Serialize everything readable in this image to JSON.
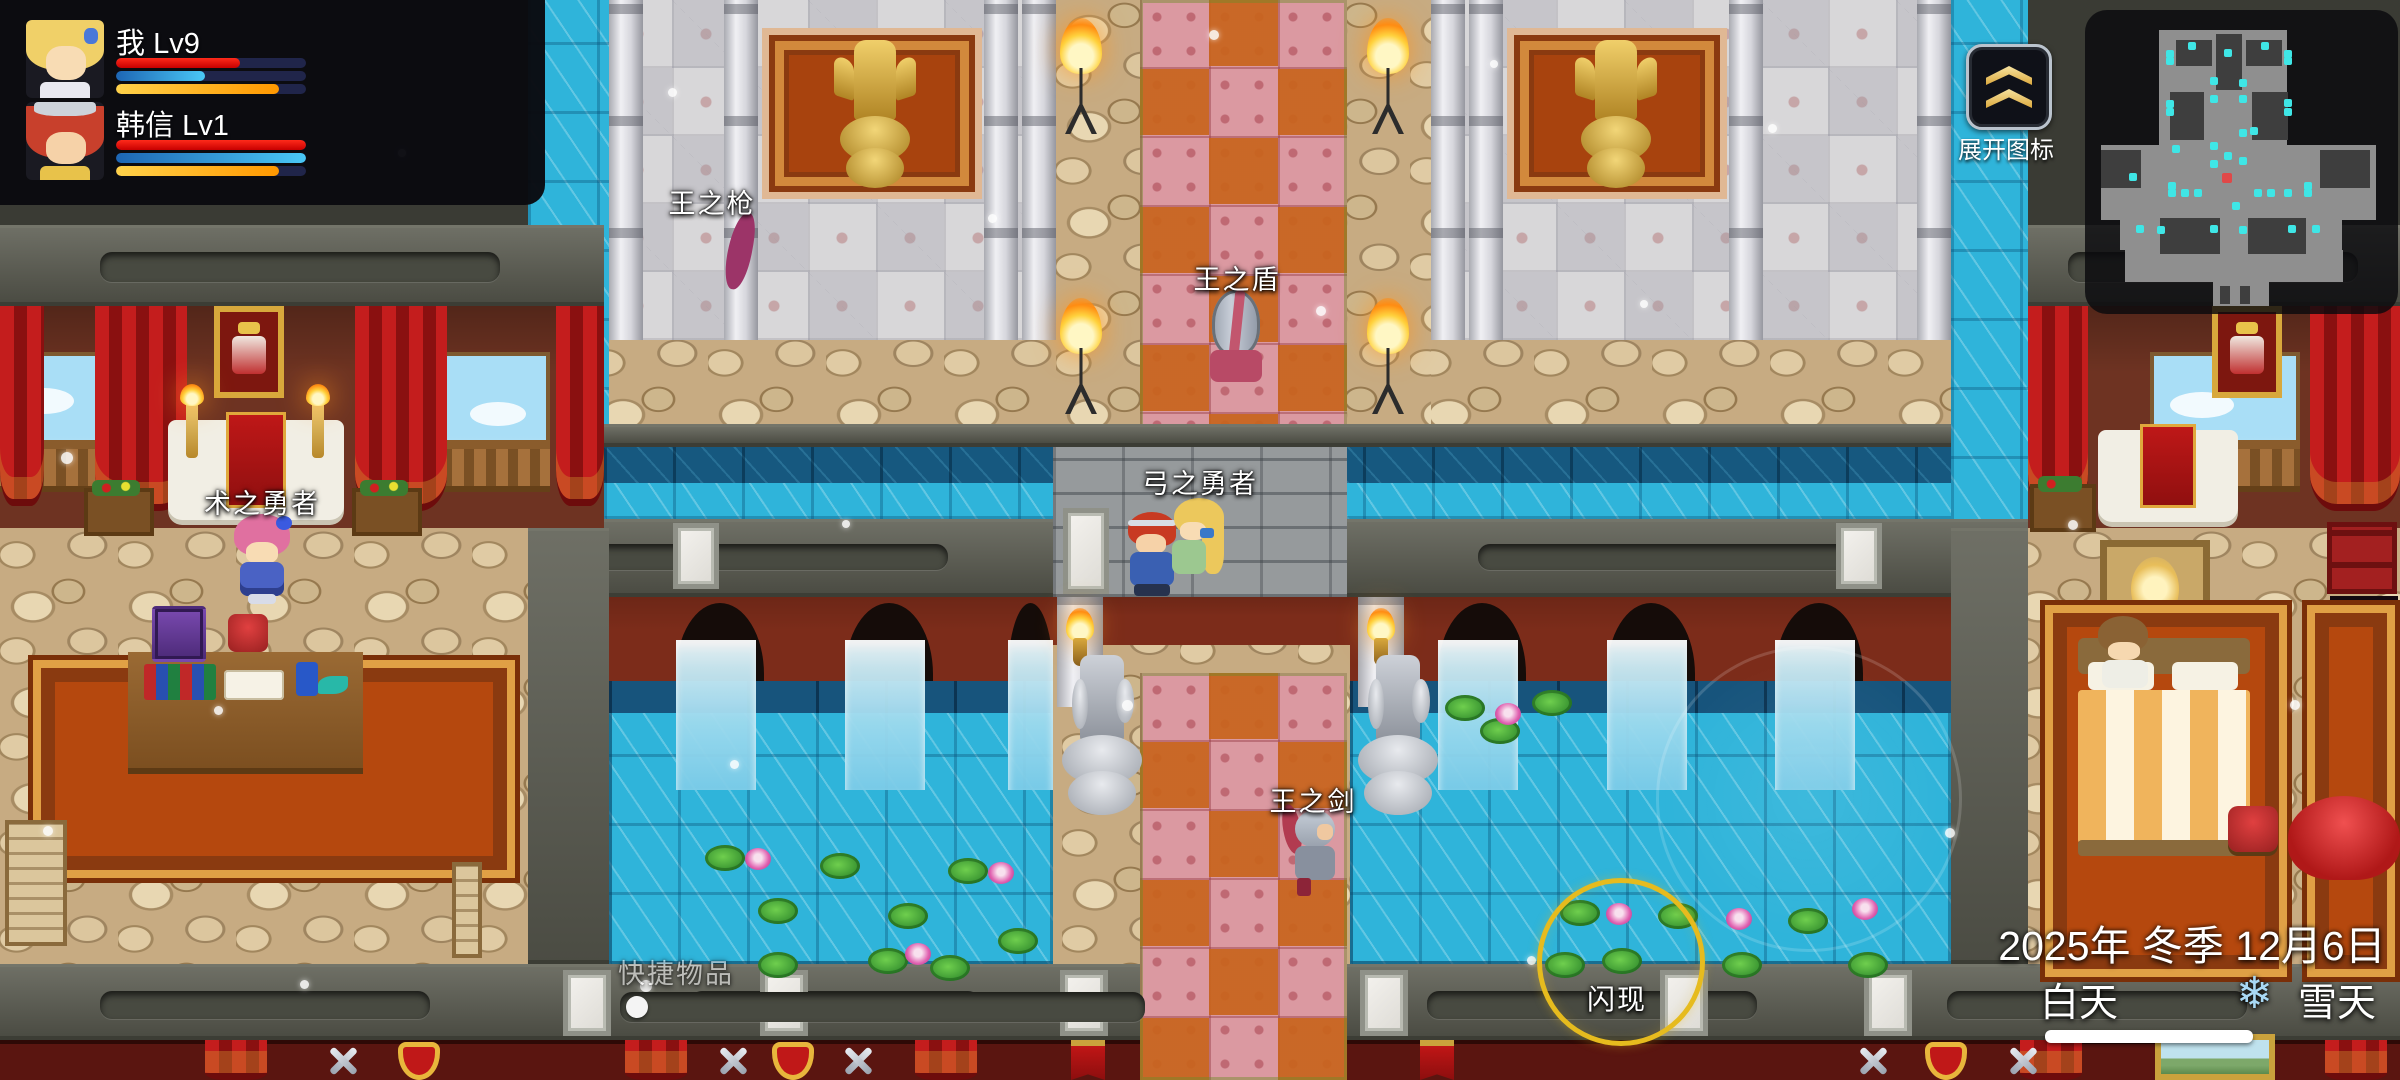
{
  "ui": {
    "party": {
      "members": [
        {
          "name": "我",
          "level": "Lv9",
          "hp": "65%",
          "mp": "47%",
          "tp": "86%"
        },
        {
          "name": "韩信",
          "level": "Lv1",
          "hp": "100%",
          "mp": "100%",
          "tp": "86%"
        }
      ]
    },
    "expand_button": {
      "label": "展开图标"
    },
    "skill_button": {
      "label": "闪现"
    },
    "quickbar": {
      "label": "快捷物品"
    },
    "hud": {
      "date": "2025年 冬季 12月6日",
      "time_of_day": "白天",
      "weather": "雪天",
      "weather_icon": "❄"
    }
  },
  "npc_labels": [
    {
      "text": "王之枪"
    },
    {
      "text": "王之盾"
    },
    {
      "text": "弓之勇者"
    },
    {
      "text": "王之剑"
    },
    {
      "text": "术之勇者"
    }
  ],
  "minimap": {
    "dot_color": "#3fe6e6",
    "player_color": "#e04848",
    "player": [
      2222,
      173
    ],
    "dots": [
      [
        2188,
        42
      ],
      [
        2261,
        42
      ],
      [
        2224,
        49
      ],
      [
        2166,
        50
      ],
      [
        2284,
        50
      ],
      [
        2166,
        57
      ],
      [
        2284,
        57
      ],
      [
        2210,
        77
      ],
      [
        2239,
        79
      ],
      [
        2210,
        95
      ],
      [
        2239,
        95
      ],
      [
        2166,
        100
      ],
      [
        2284,
        99
      ],
      [
        2166,
        108
      ],
      [
        2284,
        108
      ],
      [
        2172,
        145
      ],
      [
        2210,
        142
      ],
      [
        2239,
        129
      ],
      [
        2250,
        127
      ],
      [
        2129,
        173
      ],
      [
        2224,
        152
      ],
      [
        2210,
        160
      ],
      [
        2239,
        157
      ],
      [
        2168,
        182
      ],
      [
        2168,
        189
      ],
      [
        2181,
        189
      ],
      [
        2194,
        189
      ],
      [
        2254,
        189
      ],
      [
        2267,
        189
      ],
      [
        2284,
        189
      ],
      [
        2304,
        182
      ],
      [
        2304,
        189
      ],
      [
        2232,
        202
      ],
      [
        2136,
        225
      ],
      [
        2157,
        226
      ],
      [
        2210,
        225
      ],
      [
        2239,
        226
      ],
      [
        2288,
        225
      ],
      [
        2312,
        225
      ]
    ]
  },
  "effects": {
    "snow": [
      [
        61,
        452,
        12
      ],
      [
        43,
        826,
        10
      ],
      [
        214,
        706,
        9
      ],
      [
        398,
        149,
        8
      ],
      [
        640,
        980,
        12
      ],
      [
        988,
        214,
        9
      ],
      [
        1316,
        306,
        10
      ],
      [
        1122,
        700,
        11
      ],
      [
        1768,
        124,
        9
      ],
      [
        2068,
        520,
        10
      ],
      [
        1527,
        956,
        9
      ],
      [
        842,
        520,
        8
      ],
      [
        1945,
        828,
        10
      ],
      [
        668,
        88,
        9
      ],
      [
        1209,
        30,
        10
      ],
      [
        300,
        980,
        9
      ],
      [
        1640,
        300,
        8
      ],
      [
        2290,
        700,
        10
      ],
      [
        1490,
        60,
        8
      ],
      [
        730,
        760,
        9
      ]
    ],
    "lilies": [
      [
        705,
        845
      ],
      [
        758,
        898
      ],
      [
        820,
        853
      ],
      [
        888,
        903
      ],
      [
        948,
        858
      ],
      [
        868,
        948
      ],
      [
        758,
        952
      ],
      [
        998,
        928
      ],
      [
        930,
        955
      ],
      [
        1445,
        695
      ],
      [
        1480,
        718
      ],
      [
        1532,
        690
      ],
      [
        1560,
        900
      ],
      [
        1602,
        948
      ],
      [
        1658,
        903
      ],
      [
        1722,
        952
      ],
      [
        1788,
        908
      ],
      [
        1848,
        952
      ],
      [
        1545,
        952
      ]
    ],
    "flowers": [
      [
        745,
        848
      ],
      [
        905,
        943
      ],
      [
        988,
        862
      ],
      [
        1495,
        703
      ],
      [
        1606,
        903
      ],
      [
        1726,
        908
      ],
      [
        1852,
        898
      ]
    ]
  },
  "colors": {
    "hp": "#e01010",
    "mp_start": "#1d66b4",
    "mp_end": "#4ac8f6",
    "tp_start": "#ffd24a",
    "tp_end": "#ff9800",
    "bar_bg": "#20254a",
    "accent_gold": "#e9c469",
    "skill_ring": "#e6bb1e"
  }
}
